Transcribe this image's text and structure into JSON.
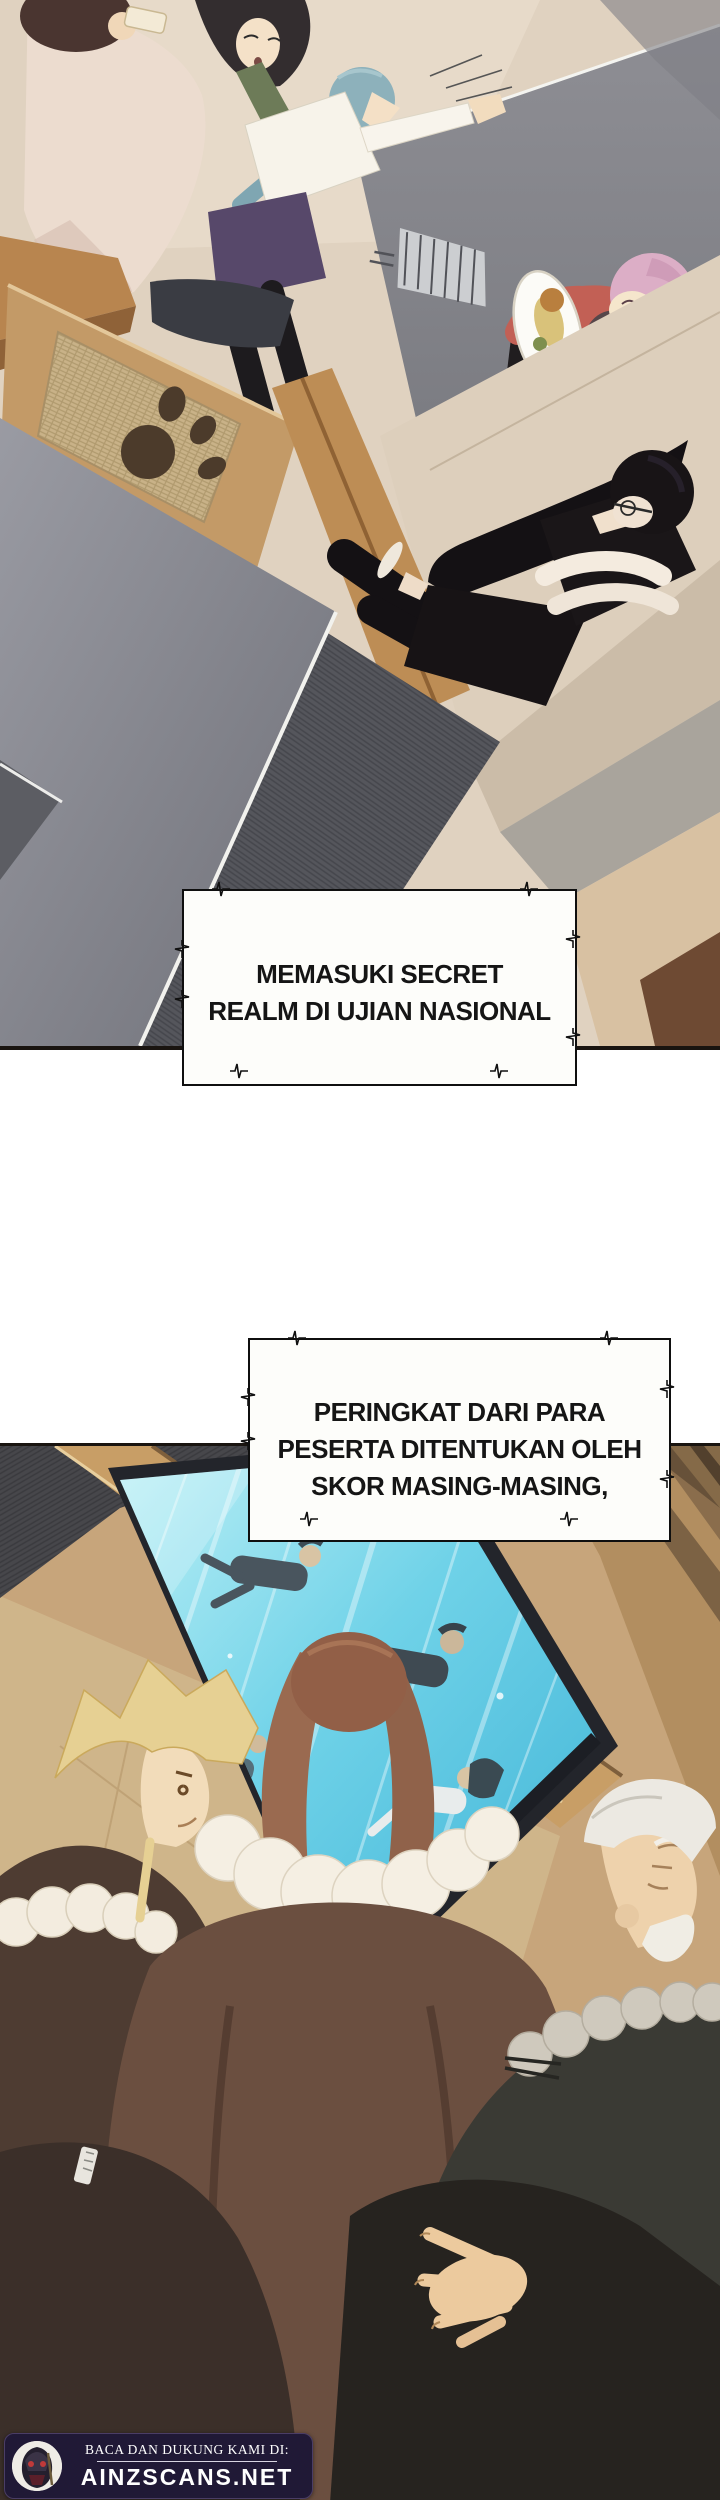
{
  "page": {
    "width": 720,
    "height": 2500,
    "background": "#ffffff"
  },
  "captions": {
    "box1": {
      "lines": [
        "MEMASUKI SECRET",
        "REALM DI UJIAN NASIONAL"
      ]
    },
    "box2": {
      "lines": [
        "PERINGKAT DARI PARA",
        "PESERTA DITENTUKAN OLEH",
        "SKOR MASING-MASING,"
      ]
    }
  },
  "footer": {
    "tagline": "BACA DAN DUKUNG KAMI DI:",
    "site": "AINZSCANS.NET"
  },
  "colors": {
    "caption_bg": "#fdfdfa",
    "caption_border": "#0f0f0f",
    "caption_text": "#151515",
    "footer_bg": "#201936",
    "footer_text": "#ffffff",
    "screen_cyan": "#58c8e2",
    "floor_beige": "#e0d2c0",
    "wall_gray": "#8f9098",
    "wood_tan": "#c59a66",
    "panel_wall_tan": "#c7a57b"
  }
}
